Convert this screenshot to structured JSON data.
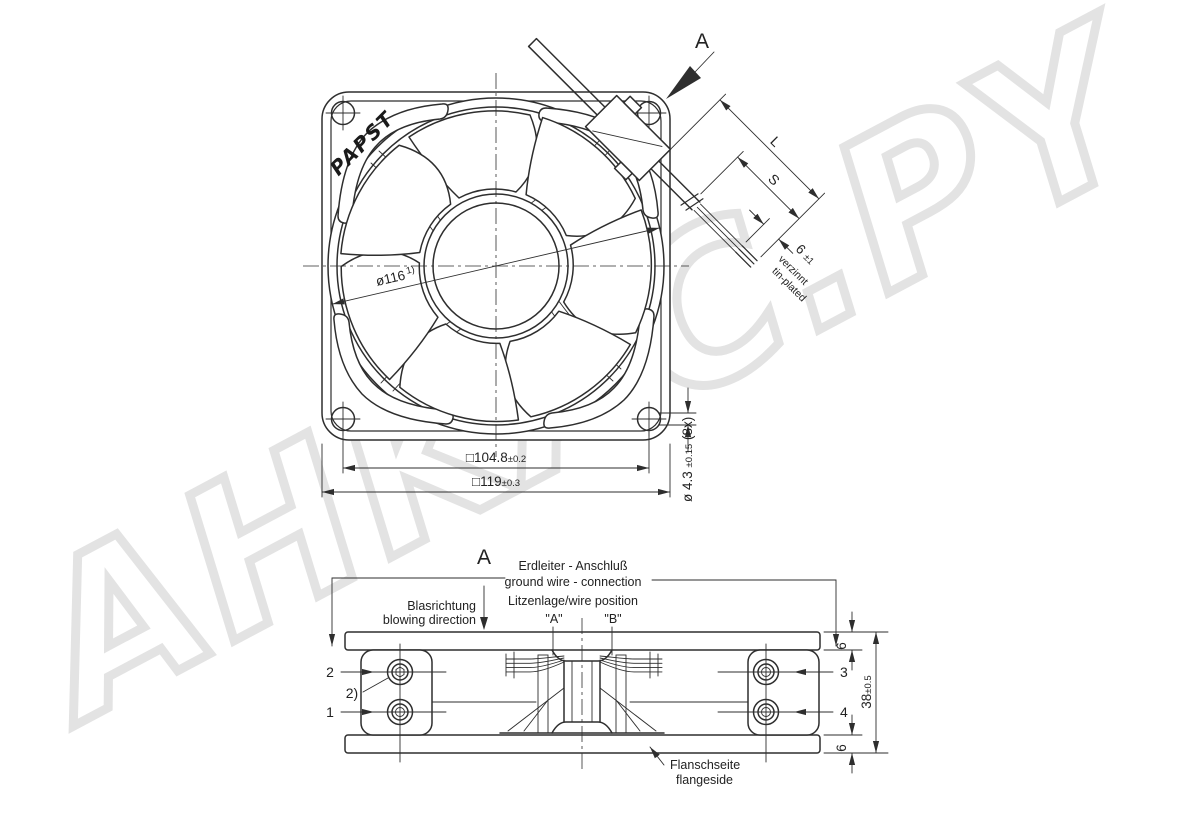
{
  "watermark": {
    "text": "AHKAC.PY"
  },
  "brand_logo": "PAPST",
  "view_arrow": {
    "label": "A"
  },
  "top_view": {
    "impeller_dia": {
      "main": "ø116",
      "sup": "1)"
    },
    "dim_hole_spacing": {
      "main": "□104.8",
      "tol": "±0.2"
    },
    "dim_frame": {
      "main": "□119",
      "tol": "±0.3"
    },
    "dim_hole": {
      "main": "ø 4.3 ",
      "tol": "±0.15",
      "count": " (8x)"
    },
    "cable": {
      "len": "L",
      "strip": "S",
      "tip": {
        "main": "6 ",
        "tol": "±1"
      },
      "note_de": "verzinnt",
      "note_en": "tin-plated"
    }
  },
  "side_view": {
    "view_label": "A",
    "blowing": {
      "de": "Blasrichtung",
      "en": "blowing direction"
    },
    "ground": {
      "de": "Erdleiter - Anschluß",
      "en": "ground wire - connection"
    },
    "wire_position": {
      "label": "Litzenlage/wire position",
      "a": "\"A\"",
      "b": "\"B\""
    },
    "callouts": {
      "c1": "1",
      "c2": "2",
      "c2_note": "2)",
      "c3": "3",
      "c4": "4"
    },
    "dims": {
      "flange_top": "6",
      "flange_bottom": "6",
      "depth": {
        "main": "38",
        "tol": "±0.5"
      }
    },
    "flange_side": {
      "de": "Flanschseite",
      "en": "flangeside"
    }
  }
}
